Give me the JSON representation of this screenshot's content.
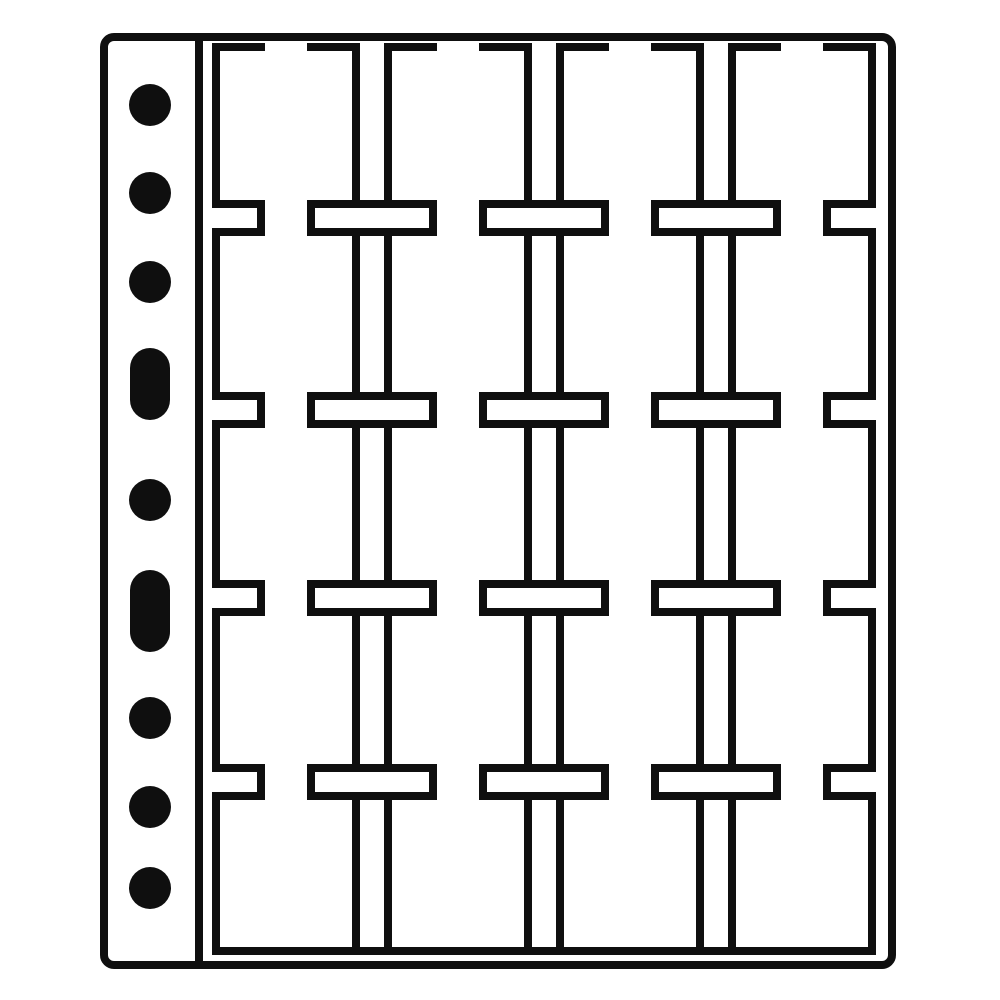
{
  "illustration": {
    "subject": "binder sheet with 4 strips of 5 pockets (20 compartments) for coin holders",
    "background_color": "#ffffff",
    "ink_color": "#0f0f0f",
    "canvas": {
      "width": 1000,
      "height": 1000
    },
    "page_outline": {
      "x": 104,
      "y": 37,
      "width": 788,
      "height": 928,
      "stroke_width": 8,
      "corner_radius": 10
    },
    "binder_margin": {
      "divider_x": 195,
      "divider_top_y": 37,
      "divider_bottom_y": 965,
      "divider_thickness": 8
    },
    "binder_holes": {
      "center_x": 150,
      "round_hole_radius": 21,
      "round_hole_centers_y": [
        105,
        193,
        282,
        500,
        718,
        807,
        888
      ],
      "oblong_holes": [
        {
          "x": 130,
          "y": 348,
          "width": 40,
          "height": 72,
          "corner_radius": 20
        },
        {
          "x": 130,
          "y": 570,
          "width": 40,
          "height": 82,
          "corner_radius": 20
        }
      ]
    },
    "pocket_grid": {
      "columns": 4,
      "rows": 5,
      "column_left_edges_x": [
        212,
        384,
        556,
        728
      ],
      "column_width": 148,
      "line_thickness": 8,
      "top_edge_y": 43,
      "top_dash_end_offset": 53,
      "top_gap_end_offset": 95,
      "slit_band_tops_y": [
        200,
        392,
        580,
        764
      ],
      "slit_band_height": 36,
      "bottom_seam_y": 947
    }
  }
}
